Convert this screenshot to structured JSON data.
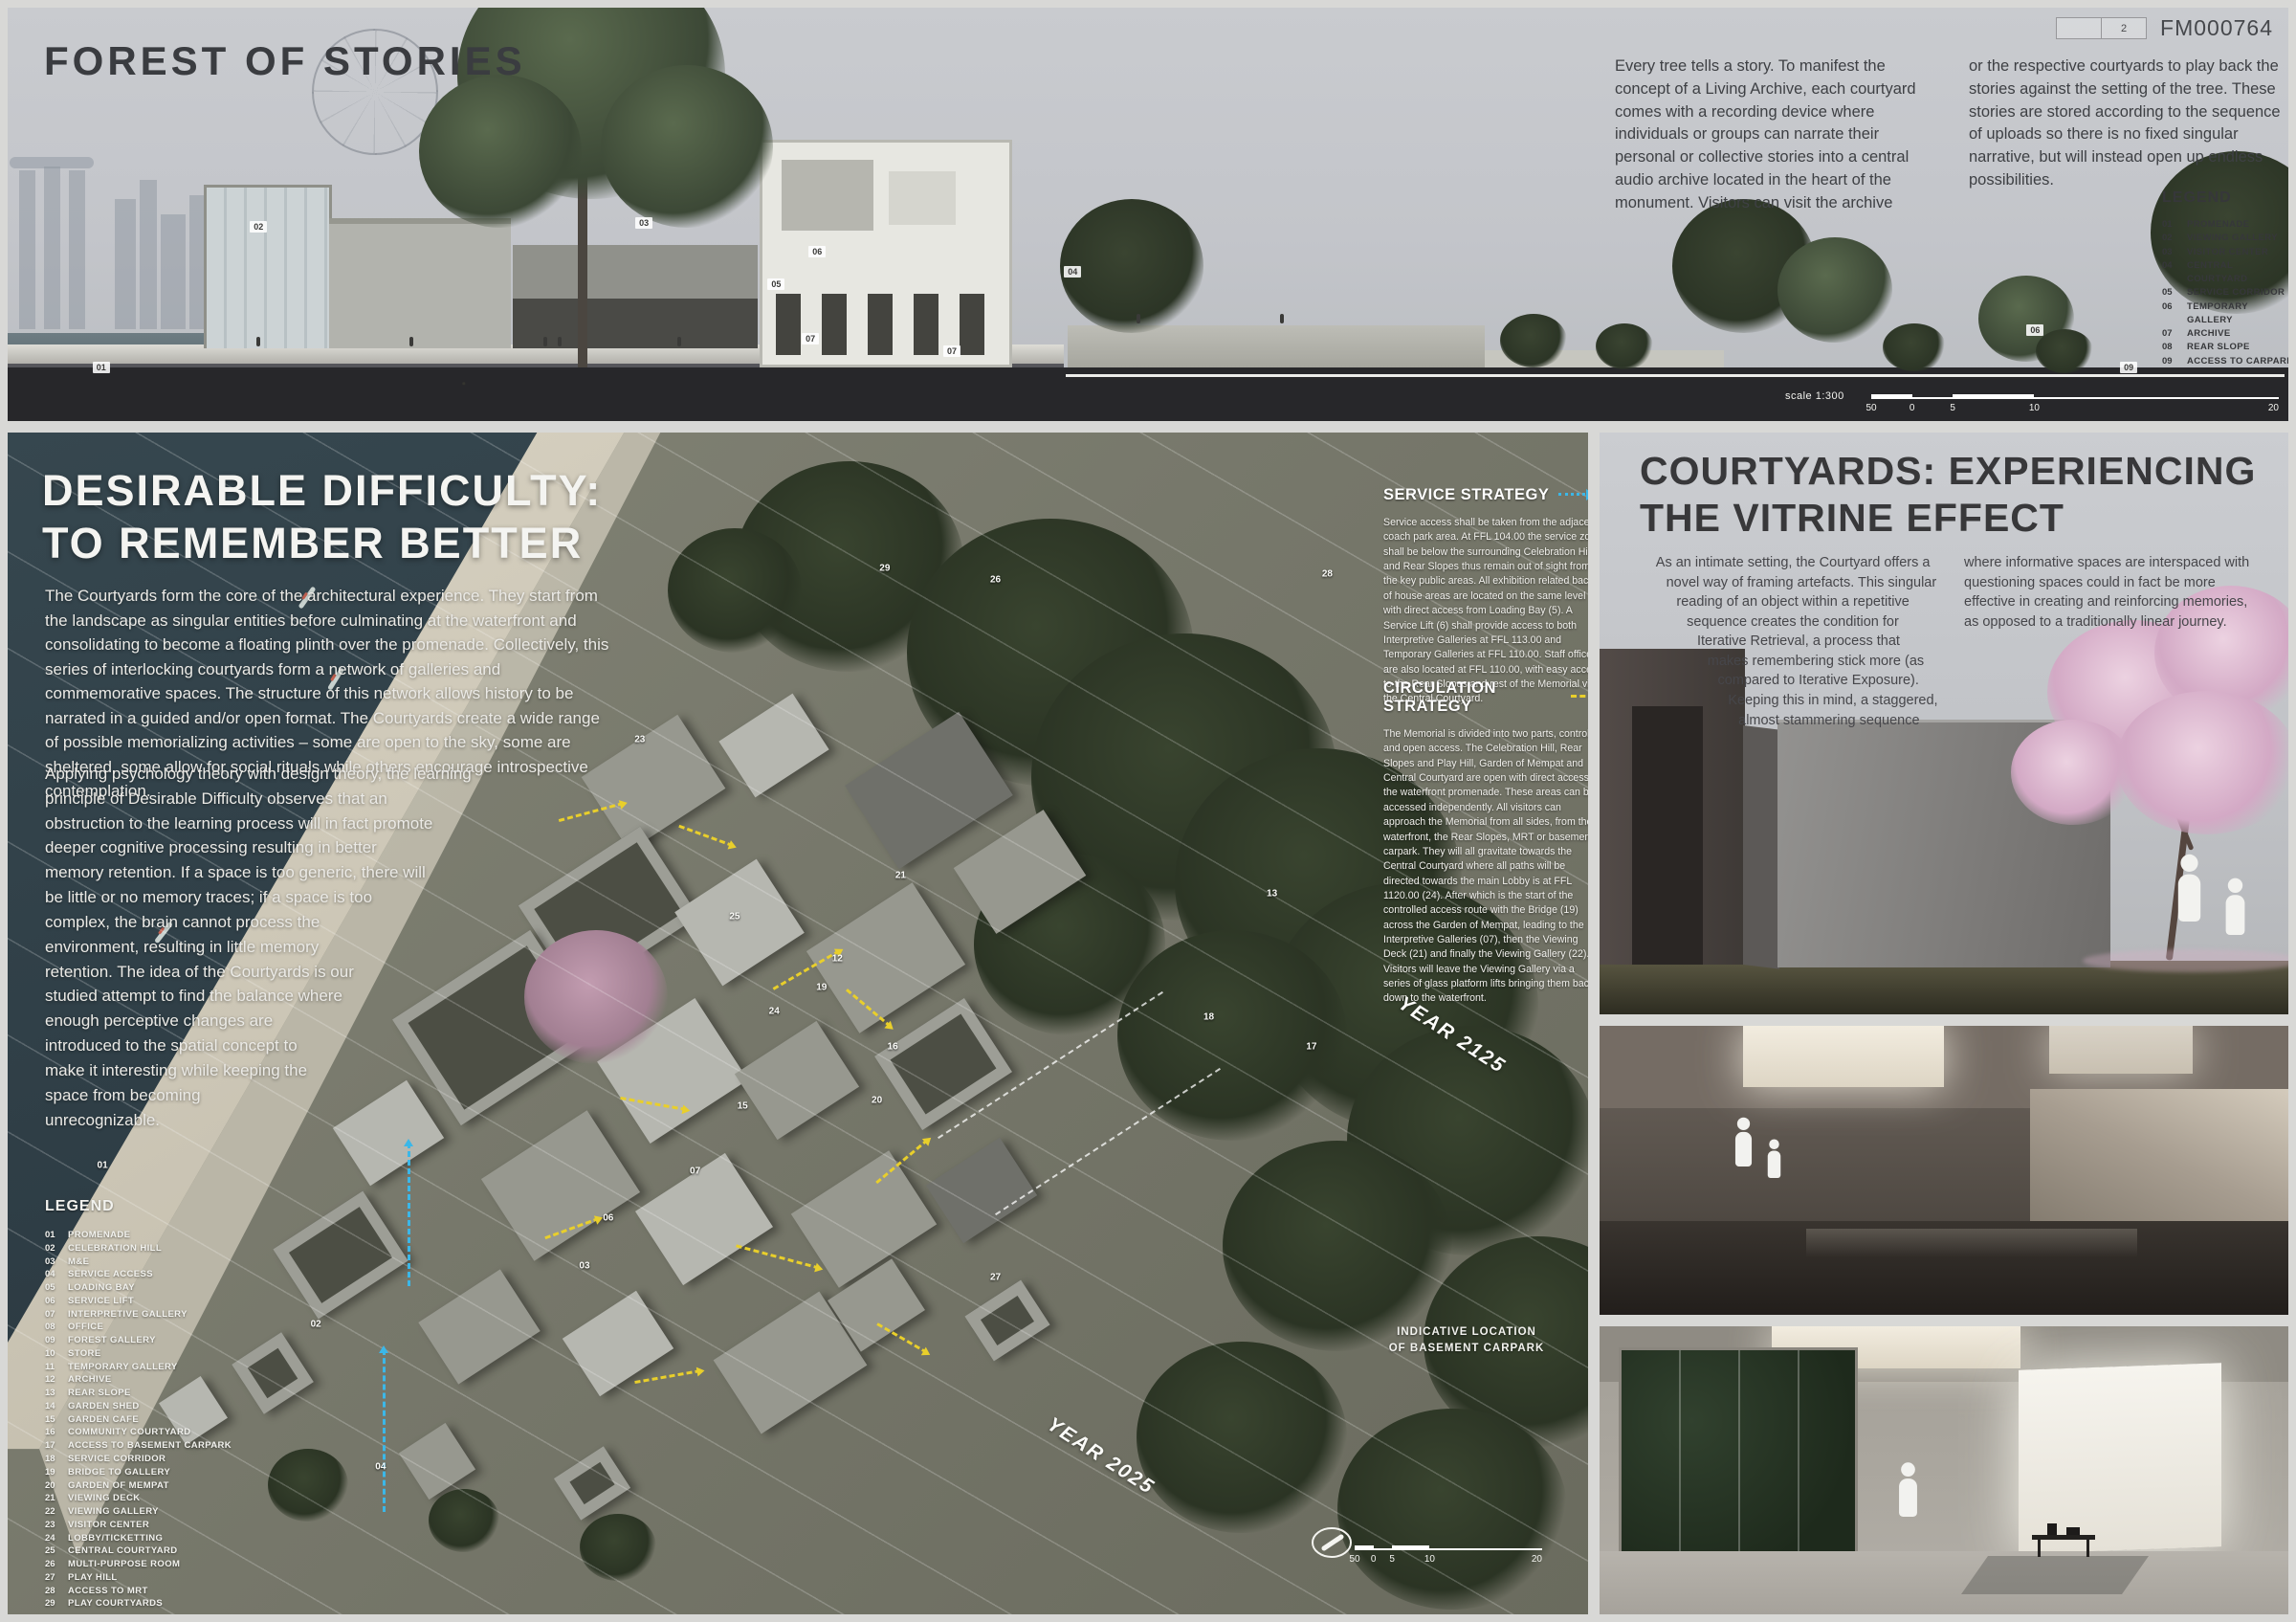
{
  "board": {
    "page_index_box": "2",
    "board_id": "FM000764"
  },
  "colors": {
    "accent_cyan": "#3bb7e8",
    "accent_yellow": "#e9cf2b"
  },
  "top_panel": {
    "title": "FOREST OF STORIES",
    "intro_col1": "Every tree tells a story. To manifest the concept of a Living Archive, each courtyard comes with a recording device where individuals or groups can narrate their personal or collective stories into a central audio archive located in the heart of the monument. Visitors can visit the archive",
    "intro_col2": "or the respective courtyards to play back the stories against the setting of the tree. These stories are stored according to the sequence of uploads so there is no fixed singular narrative, but will instead open up endless possibilities.",
    "legend_title": "LEGEND",
    "legend_items": [
      {
        "num": "01",
        "label": "PROMENADE"
      },
      {
        "num": "02",
        "label": "VIEWING GALLERY"
      },
      {
        "num": "03",
        "label": "VISITOR CENTER"
      },
      {
        "num": "04",
        "label": "CENTRAL COURTYARD"
      },
      {
        "num": "05",
        "label": "SERVICE CORRIDOR"
      },
      {
        "num": "06",
        "label": "TEMPORARY GALLERY"
      },
      {
        "num": "07",
        "label": "ARCHIVE"
      },
      {
        "num": "08",
        "label": "REAR SLOPE"
      },
      {
        "num": "09",
        "label": "ACCESS TO CARPARK"
      }
    ],
    "scale_label": "scale 1:300",
    "scale_ticks": [
      "0",
      "5",
      "10",
      "20",
      "50"
    ],
    "section_markers": [
      {
        "n": "01",
        "x": 4.1,
        "y": 87
      },
      {
        "n": "02",
        "x": 11.0,
        "y": 53
      },
      {
        "n": "03",
        "x": 27.9,
        "y": 52
      },
      {
        "n": "04",
        "x": 46.7,
        "y": 64
      },
      {
        "n": "05",
        "x": 33.7,
        "y": 67
      },
      {
        "n": "06",
        "x": 35.5,
        "y": 59
      },
      {
        "n": "07",
        "x": 35.2,
        "y": 80
      },
      {
        "n": "07",
        "x": 41.4,
        "y": 83
      },
      {
        "n": "06",
        "x": 88.9,
        "y": 78
      },
      {
        "n": "09",
        "x": 93.0,
        "y": 87
      }
    ]
  },
  "masterplan": {
    "title_line1": "DESIRABLE DIFFICULTY:",
    "title_line2": "TO REMEMBER BETTER",
    "para1": "The Courtyards form the core of the architectural experience. They start from the landscape as singular entities before culminating at the waterfront and consolidating to become a floating plinth over the promenade. Collectively, this series of interlocking courtyards form a network of galleries and commemorative spaces. The structure of this network allows history to be narrated in a guided and/or open format. The Courtyards create a wide range of possible memorializing activities – some are open to the sky, some are sheltered, some allow for social rituals while others encourage introspective contemplation.",
    "para2": "Applying psychology theory with design theory, the learning principle of Desirable Difficulty observes that an obstruction to the learning process will in fact promote deeper cognitive processing resulting in better memory retention. If a space is too generic, there will be little or no memory traces; if a space is too complex, the brain cannot process the environment, resulting in little memory retention. The idea of the Courtyards is our studied attempt to find the balance where enough perceptive changes are introduced to the spatial concept to make it interesting while keeping the space from becoming unrecognizable.",
    "legend_title": "LEGEND",
    "legend_items": [
      {
        "num": "01",
        "label": "PROMENADE"
      },
      {
        "num": "02",
        "label": "CELEBRATION HILL"
      },
      {
        "num": "03",
        "label": "M&E"
      },
      {
        "num": "04",
        "label": "SERVICE ACCESS"
      },
      {
        "num": "05",
        "label": "LOADING BAY"
      },
      {
        "num": "06",
        "label": "SERVICE LIFT"
      },
      {
        "num": "07",
        "label": "INTERPRETIVE GALLERY"
      },
      {
        "num": "08",
        "label": "OFFICE"
      },
      {
        "num": "09",
        "label": "FOREST GALLERY"
      },
      {
        "num": "10",
        "label": "STORE"
      },
      {
        "num": "11",
        "label": "TEMPORARY GALLERY"
      },
      {
        "num": "12",
        "label": "ARCHIVE"
      },
      {
        "num": "13",
        "label": "REAR SLOPE"
      },
      {
        "num": "14",
        "label": "GARDEN SHED"
      },
      {
        "num": "15",
        "label": "GARDEN CAFE"
      },
      {
        "num": "16",
        "label": "COMMUNITY COURTYARD"
      },
      {
        "num": "17",
        "label": "ACCESS TO BASEMENT CARPARK"
      },
      {
        "num": "18",
        "label": "SERVICE CORRIDOR"
      },
      {
        "num": "19",
        "label": "BRIDGE TO GALLERY"
      },
      {
        "num": "20",
        "label": "GARDEN OF MEMPAT"
      },
      {
        "num": "21",
        "label": "VIEWING DECK"
      },
      {
        "num": "22",
        "label": "VIEWING GALLERY"
      },
      {
        "num": "23",
        "label": "VISITOR CENTER"
      },
      {
        "num": "24",
        "label": "LOBBY/TICKETTING"
      },
      {
        "num": "25",
        "label": "CENTRAL COURTYARD"
      },
      {
        "num": "26",
        "label": "MULTI-PURPOSE ROOM"
      },
      {
        "num": "27",
        "label": "PLAY HILL"
      },
      {
        "num": "28",
        "label": "ACCESS TO MRT"
      },
      {
        "num": "29",
        "label": "PLAY COURTYARDS"
      }
    ],
    "service": {
      "heading": "SERVICE STRATEGY",
      "body": "Service access shall be taken from the adjacent coach park area. At FFL 104.00 the service zone shall be below the surrounding Celebration Hill and Rear Slopes thus remain out of sight from the key public areas. All exhibition related back of house areas are located on the same level with direct access from Loading Bay (5). A Service Lift (6) shall provide access to both Interpretive Galleries at FFL 113.00 and Temporary Galleries at FFL 110.00. Staff office are also located at FFL 110.00, with easy access to the Rear Slopes and rest of the Memorial via the Central Courtyard."
    },
    "circulation": {
      "heading": "CIRCULATION STRATEGY",
      "body": "The Memorial is divided into two parts, controlled and open access. The Celebration Hill, Rear Slopes and Play Hill, Garden of Mempat and Central Courtyard are open with direct access to the waterfront promenade. These areas can be accessed independently. All visitors can approach the Memorial from all sides, from the waterfront, the Rear Slopes, MRT or basement carpark. They will all gravitate towards the Central Courtyard where all paths will be directed towards the main Lobby is at FFL 1120.00 (24). After which is the start of the controlled access route with the Bridge (19) across the Garden of Mempat, leading to the Interpretive Galleries (07), then the Viewing Deck (21) and finally the Viewing Gallery (22). Visitors will leave the Viewing Gallery via a series of glass platform lifts bringing them back down to the waterfront."
    },
    "year_far": "YEAR 2125",
    "year_near": "YEAR 2025",
    "carpark_label_line1": "INDICATIVE LOCATION",
    "carpark_label_line2": "OF BASEMENT CARPARK",
    "scale_ticks": [
      "0",
      "5",
      "10",
      "20",
      "50"
    ],
    "plan_markers": [
      {
        "n": "29",
        "x": 55.5,
        "y": 11.5
      },
      {
        "n": "26",
        "x": 62.5,
        "y": 12.5
      },
      {
        "n": "28",
        "x": 83.5,
        "y": 12.0
      },
      {
        "n": "23",
        "x": 40.0,
        "y": 26.0
      },
      {
        "n": "21",
        "x": 56.5,
        "y": 37.5
      },
      {
        "n": "13",
        "x": 80.0,
        "y": 39.0
      },
      {
        "n": "25",
        "x": 46.0,
        "y": 41.0
      },
      {
        "n": "12",
        "x": 52.5,
        "y": 44.5
      },
      {
        "n": "19",
        "x": 51.5,
        "y": 47.0
      },
      {
        "n": "24",
        "x": 48.5,
        "y": 49.0
      },
      {
        "n": "18",
        "x": 76.0,
        "y": 49.5
      },
      {
        "n": "16",
        "x": 56.0,
        "y": 52.0
      },
      {
        "n": "17",
        "x": 82.5,
        "y": 52.0
      },
      {
        "n": "20",
        "x": 55.0,
        "y": 56.5
      },
      {
        "n": "15",
        "x": 46.5,
        "y": 57.0
      },
      {
        "n": "07",
        "x": 43.5,
        "y": 62.5
      },
      {
        "n": "06",
        "x": 38.0,
        "y": 66.5
      },
      {
        "n": "01",
        "x": 6.0,
        "y": 62.0
      },
      {
        "n": "03",
        "x": 36.5,
        "y": 70.5
      },
      {
        "n": "27",
        "x": 62.5,
        "y": 71.5
      },
      {
        "n": "02",
        "x": 19.5,
        "y": 75.5
      },
      {
        "n": "04",
        "x": 23.6,
        "y": 87.5
      }
    ]
  },
  "vitrine_panel": {
    "title_line1": "COURTYARDS: EXPERIENCING",
    "title_line2": "THE VITRINE EFFECT",
    "col1": "As an intimate setting, the Courtyard offers a novel way of framing artefacts. This singular reading of an object within a repetitive sequence creates the condition for Iterative Retrieval, a process that makes remembering stick more (as compared to Iterative Exposure). Keeping this in mind, a staggered, almost stammering sequence",
    "col2": "where informative spaces are interspaced with questioning spaces could in fact be more effective in creating and reinforcing memories, as opposed to a traditionally linear journey."
  }
}
